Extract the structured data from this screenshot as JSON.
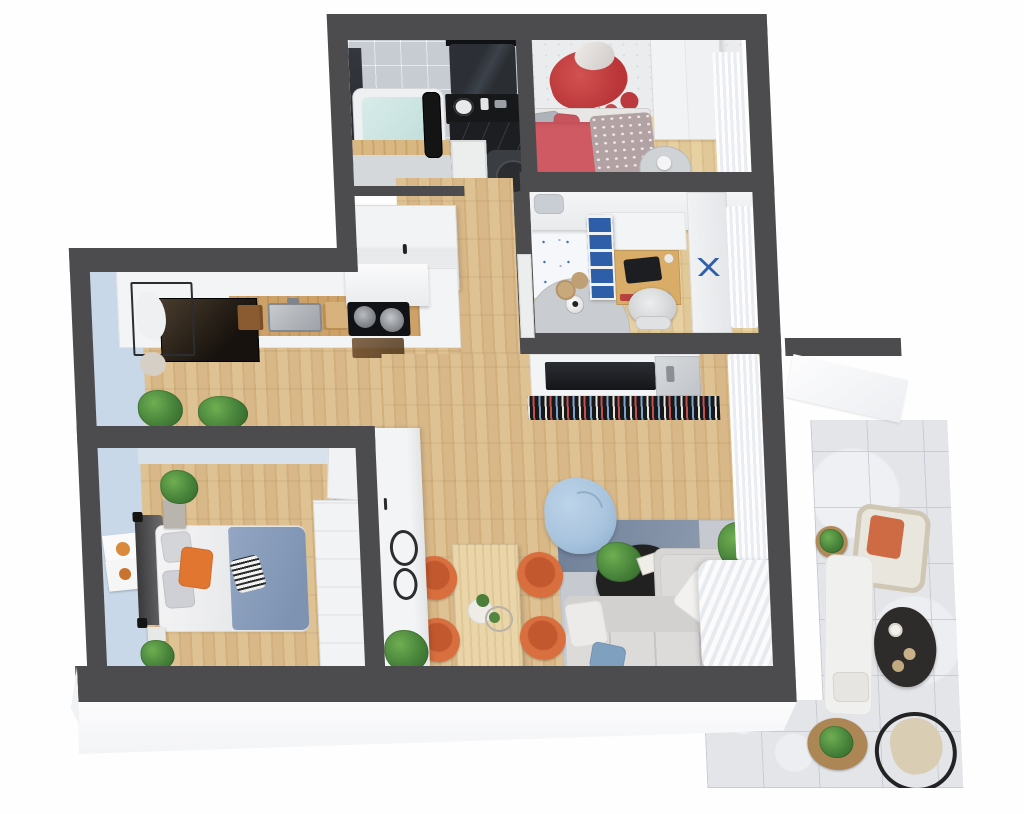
{
  "scene": {
    "label": "3D rendered top-view floor plan of a two-bedroom apartment with balcony",
    "render_style": "isometric architectural visualization, dark grey walls, oak floors"
  },
  "palette": {
    "wall": "#4c4c4e",
    "woodA": "#dfc294",
    "woodB": "#d2b07c",
    "woodC": "#d8b888",
    "woodLA": "#e7d0a2",
    "woodLB": "#dbc08e",
    "woodLC": "#e1c898",
    "tile": "#c6ccd2",
    "blueWall": "#c8d8e8",
    "white": "#f3f4f6",
    "sofa": "#d8d6d4",
    "rugGrey": "#c6cad0",
    "rugBlue": "#76879e",
    "orangeChair": "#d96f3f",
    "orangeSeat": "#c2582e",
    "bedBlue": "#93a7c4",
    "pillowOrange": "#e0762f",
    "beanBag": "#a9c4de",
    "bedRed": "#cf5a63",
    "foxRed": "#c23b3e",
    "shelfBlue": "#2e5ea8",
    "deskWood": "#d9ad67",
    "marble": "#e3e5e9",
    "black": "#17181a",
    "curtainB": "#e9ecf0",
    "counterWood": "#c89b62",
    "starBlue": "#3f6db0",
    "slab": "#fafbfc"
  },
  "rooms": {
    "bathroom": {
      "label": "Bathroom",
      "furniture": [
        "bathtub",
        "shower-screen",
        "black-vanity",
        "vanity-mirror",
        "towel-ladder",
        "wood-deck"
      ]
    },
    "wc": {
      "label": "WC (black marble)",
      "furniture": [
        "toilet",
        "white-door"
      ]
    },
    "kids_room": {
      "label": "Kids bedroom",
      "furniture": [
        "single-bed-red",
        "wardrobe",
        "fox-wall-mural",
        "side-table",
        "curtain"
      ]
    },
    "teen_room": {
      "label": "Teen room",
      "furniture": [
        "loft-bed",
        "desk",
        "office-chair",
        "blue-cubby-shelf",
        "round-rug",
        "football",
        "baskets",
        "curtain"
      ]
    },
    "hallway": {
      "label": "Hallway",
      "furniture": [
        "sliding-wardrobe",
        "beaded-door-trim"
      ]
    },
    "kitchen": {
      "label": "Kitchen",
      "furniture": [
        "counter-run",
        "sink",
        "cooktop-with-pans",
        "knife-block",
        "range-hood",
        "fridge",
        "coat-rack",
        "plants"
      ]
    },
    "master_bedroom": {
      "label": "Master bedroom",
      "furniture": [
        "double-bed",
        "headboard",
        "nightstands",
        "plants",
        "wall-art",
        "console",
        "door"
      ]
    },
    "dining": {
      "label": "Dining area",
      "furniture": [
        "wood-table",
        "four-orange-chairs",
        "centerpiece",
        "tall-cabinet-with-mirrors",
        "plant"
      ]
    },
    "living": {
      "label": "Living room",
      "furniture": [
        "corner-sofa",
        "rug",
        "black-coffee-table",
        "tv-wall-unit",
        "media-shelf",
        "bean-bag",
        "plant",
        "curtains"
      ]
    },
    "balcony": {
      "label": "Balcony terrace",
      "furniture": [
        "wicker-armchair",
        "black-coffee-table",
        "white-lounger",
        "round-plant-tables",
        "hanging-chair"
      ]
    }
  }
}
